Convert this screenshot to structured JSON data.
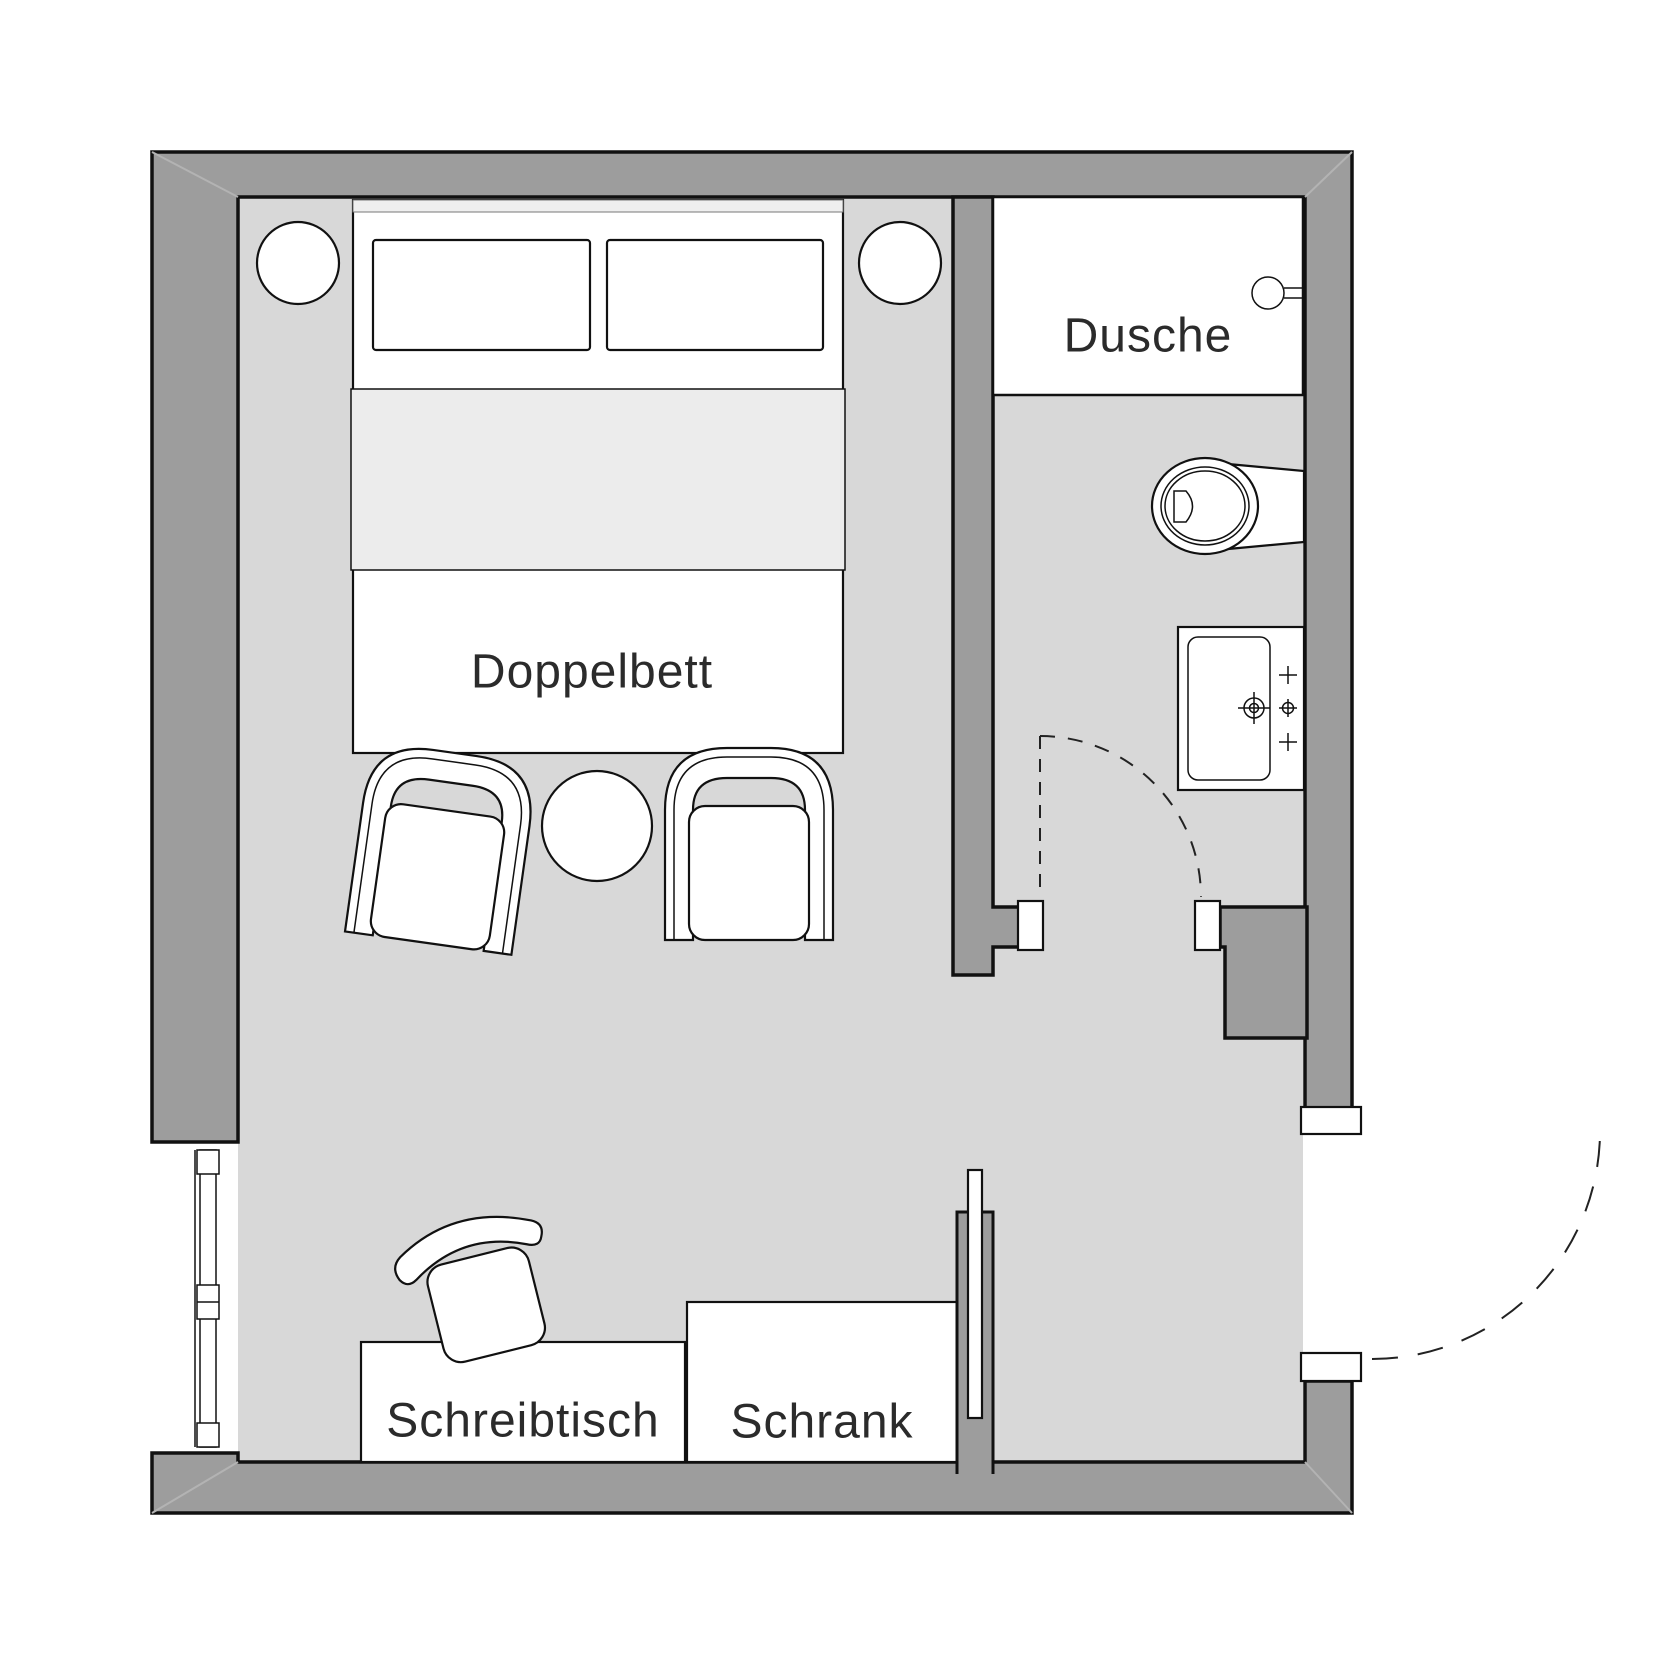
{
  "floorplan": {
    "type": "hotel-room-floor-plan",
    "labels": {
      "bed": "Doppelbett",
      "shower": "Dusche",
      "desk": "Schreibtisch",
      "wardrobe": "Schrank"
    },
    "colors": {
      "wall": "#9d9d9d",
      "floor": "#d8d8d8",
      "blanket": "#ececec",
      "bedstrip": "#efefef",
      "outline": "#111111"
    }
  }
}
